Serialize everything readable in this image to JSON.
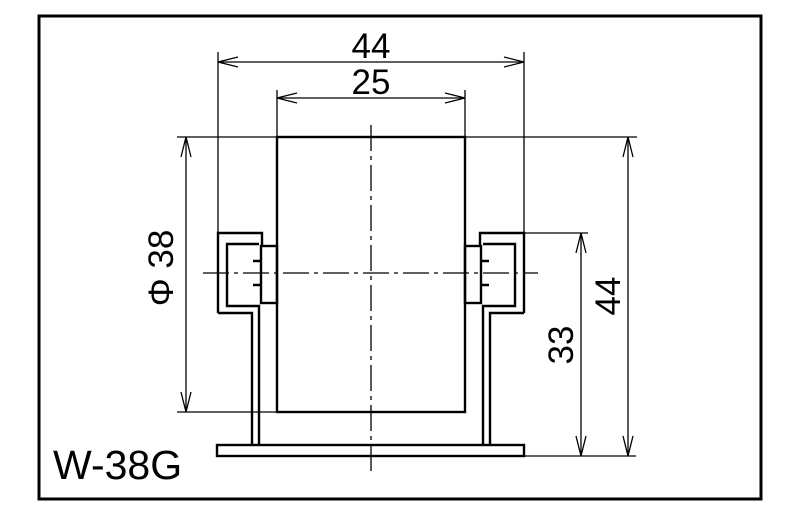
{
  "drawing": {
    "title": "W-38G",
    "dimensions": {
      "top_width": "44",
      "wheel_width": "25",
      "wheel_diameter": "Φ 38",
      "frame_height": "33",
      "overall_height": "44"
    },
    "colors": {
      "line": "#000000",
      "background": "#ffffff"
    }
  }
}
